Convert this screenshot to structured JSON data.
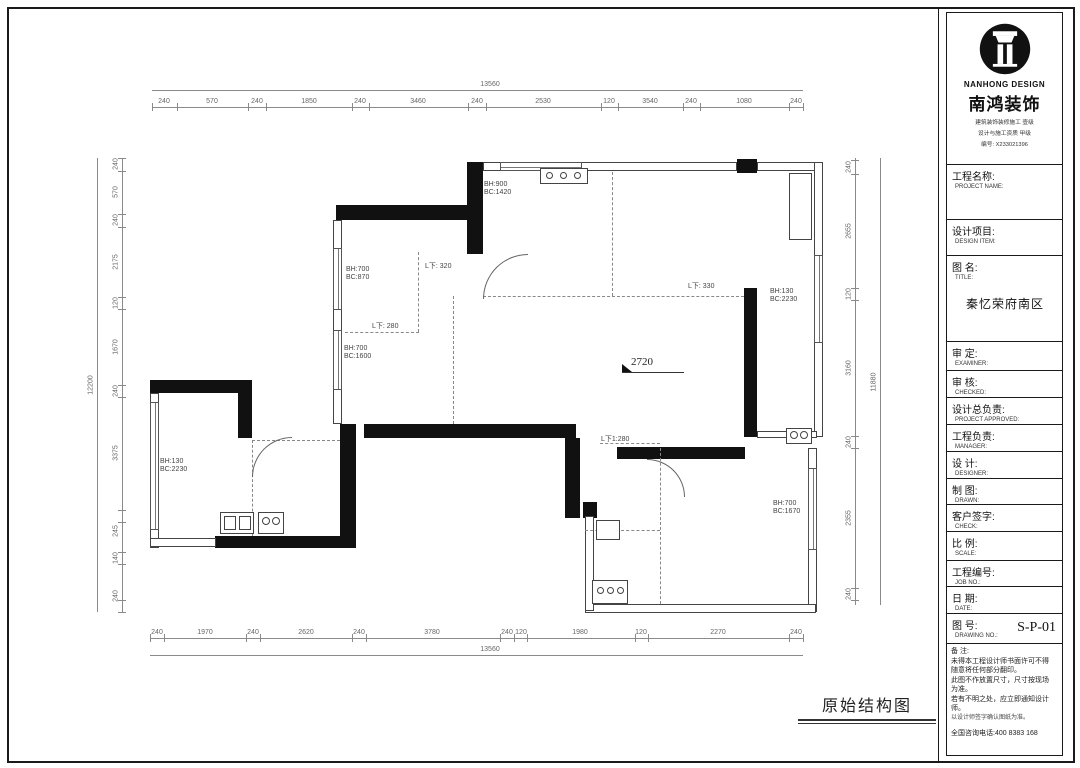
{
  "caption": "原始结构图",
  "titleblock": {
    "brand_en": "NANHONG DESIGN",
    "brand_zh": "南鸿装饰",
    "cert_lines": [
      "建筑装饰装修施工 壹级",
      "设计与施工资质 甲级",
      "编号: X233021396"
    ],
    "rows": [
      {
        "zh": "工程名称:",
        "en": "PROJECT NAME:",
        "h": 55
      },
      {
        "zh": "设计项目:",
        "en": "DESIGN ITEM:",
        "h": 36
      },
      {
        "zh": "图  名:",
        "en": "TITLE:",
        "value": "秦忆荣府南区",
        "h": 86
      },
      {
        "zh": "审  定:",
        "en": "EXAMINER:",
        "h": 29
      },
      {
        "zh": "审  核:",
        "en": "CHECKED:",
        "h": 27
      },
      {
        "zh": "设计总负责:",
        "en": "PROJECT APPROVED:",
        "h": 27
      },
      {
        "zh": "工程负责:",
        "en": "MANAGER:",
        "h": 27
      },
      {
        "zh": "设  计:",
        "en": "DESIGNER:",
        "h": 27
      },
      {
        "zh": "制  图:",
        "en": "DRAWN:",
        "h": 26
      },
      {
        "zh": "客户签字:",
        "en": "CHECK:",
        "h": 27
      },
      {
        "zh": "比  例:",
        "en": "SCALE:",
        "h": 29
      },
      {
        "zh": "工程编号:",
        "en": "JOB NO.:",
        "h": 26
      },
      {
        "zh": "日  期:",
        "en": "DATE:",
        "h": 27
      },
      {
        "zh": "图  号:",
        "en": "DRAWING NO.:",
        "drawing_no": "S-P-01",
        "h": 30
      }
    ],
    "notes": [
      {
        "text": "备  注:",
        "cls": ""
      },
      {
        "text": "未得本工程设计师书面许可不得",
        "cls": ""
      },
      {
        "text": "随意将任何部分翻印。",
        "cls": ""
      },
      {
        "text": "此图不作放置尺寸，尺寸按现场",
        "cls": ""
      },
      {
        "text": "为准。",
        "cls": ""
      },
      {
        "text": "若有不明之处，应立即通知设计",
        "cls": ""
      },
      {
        "text": "师。",
        "cls": ""
      },
      {
        "text": "以设计师签字确认图纸为准。",
        "cls": "small"
      },
      {
        "text": "全国咨询电话:400 8383 168",
        "cls": "phone"
      }
    ]
  },
  "plan": {
    "level_label": "2720",
    "chains": [
      {
        "o": "h",
        "line": 90,
        "a0": 152,
        "a1": 803,
        "labels": [
          {
            "v": "13560",
            "p": 490
          }
        ]
      },
      {
        "o": "h",
        "line": 107,
        "a0": 152,
        "a1": 803,
        "ticks": [
          152,
          177,
          248,
          266,
          352,
          369,
          468,
          486,
          601,
          618,
          683,
          700,
          789,
          803
        ],
        "labels": [
          {
            "v": "240",
            "p": 164
          },
          {
            "v": "570",
            "p": 212
          },
          {
            "v": "240",
            "p": 257
          },
          {
            "v": "1850",
            "p": 309
          },
          {
            "v": "240",
            "p": 360
          },
          {
            "v": "3460",
            "p": 418
          },
          {
            "v": "240",
            "p": 477
          },
          {
            "v": "2530",
            "p": 543
          },
          {
            "v": "120",
            "p": 609
          },
          {
            "v": "3540",
            "p": 650
          },
          {
            "v": "240",
            "p": 691
          },
          {
            "v": "1080",
            "p": 744
          },
          {
            "v": "240",
            "p": 796
          }
        ]
      },
      {
        "o": "h",
        "line": 638,
        "a0": 150,
        "a1": 803,
        "ticks": [
          150,
          164,
          246,
          260,
          352,
          366,
          500,
          514,
          527,
          635,
          648,
          789,
          803
        ],
        "labels": [
          {
            "v": "240",
            "p": 157
          },
          {
            "v": "1970",
            "p": 205
          },
          {
            "v": "240",
            "p": 253
          },
          {
            "v": "2620",
            "p": 306
          },
          {
            "v": "240",
            "p": 359
          },
          {
            "v": "3780",
            "p": 432
          },
          {
            "v": "240",
            "p": 507
          },
          {
            "v": "120",
            "p": 521
          },
          {
            "v": "1980",
            "p": 580
          },
          {
            "v": "120",
            "p": 641
          },
          {
            "v": "2270",
            "p": 718
          },
          {
            "v": "240",
            "p": 796
          }
        ]
      },
      {
        "o": "h",
        "line": 655,
        "a0": 150,
        "a1": 803,
        "labels": [
          {
            "v": "13560",
            "p": 490
          }
        ]
      },
      {
        "o": "v",
        "line": 122,
        "a0": 158,
        "a1": 612,
        "ticks": [
          158,
          171,
          214,
          227,
          297,
          309,
          385,
          397,
          510,
          522,
          552,
          564,
          600,
          612
        ],
        "labels": [
          {
            "v": "240",
            "p": 164
          },
          {
            "v": "570",
            "p": 192
          },
          {
            "v": "240",
            "p": 220
          },
          {
            "v": "2175",
            "p": 262
          },
          {
            "v": "120",
            "p": 303
          },
          {
            "v": "1670",
            "p": 347
          },
          {
            "v": "240",
            "p": 391
          },
          {
            "v": "3375",
            "p": 453
          },
          {
            "v": "245",
            "p": 531
          },
          {
            "v": "140",
            "p": 558
          },
          {
            "v": "240",
            "p": 596
          }
        ]
      },
      {
        "o": "v",
        "line": 97,
        "a0": 158,
        "a1": 612,
        "labels": [
          {
            "v": "12200",
            "p": 385
          }
        ]
      },
      {
        "o": "v",
        "line": 855,
        "a0": 158,
        "a1": 605,
        "ticks": [
          160,
          174,
          288,
          300,
          436,
          448,
          588,
          600
        ],
        "labels": [
          {
            "v": "240",
            "p": 167
          },
          {
            "v": "2655",
            "p": 231
          },
          {
            "v": "120",
            "p": 294
          },
          {
            "v": "3160",
            "p": 368
          },
          {
            "v": "240",
            "p": 442
          },
          {
            "v": "2355",
            "p": 518
          },
          {
            "v": "240",
            "p": 594
          }
        ]
      },
      {
        "o": "v",
        "line": 880,
        "a0": 158,
        "a1": 605,
        "labels": [
          {
            "v": "11880",
            "p": 382
          }
        ]
      }
    ],
    "elements": [
      {
        "t": "black",
        "x": 336,
        "y": 205,
        "w": 147,
        "h": 15
      },
      {
        "t": "black",
        "x": 467,
        "y": 162,
        "w": 16,
        "h": 92
      },
      {
        "t": "black",
        "x": 737,
        "y": 159,
        "w": 20,
        "h": 14
      },
      {
        "t": "black",
        "x": 744,
        "y": 288,
        "w": 13,
        "h": 149
      },
      {
        "t": "black",
        "x": 364,
        "y": 424,
        "w": 212,
        "h": 14
      },
      {
        "t": "black",
        "x": 340,
        "y": 424,
        "w": 16,
        "h": 124
      },
      {
        "t": "black",
        "x": 215,
        "y": 536,
        "w": 141,
        "h": 12
      },
      {
        "t": "black",
        "x": 565,
        "y": 438,
        "w": 15,
        "h": 80
      },
      {
        "t": "black",
        "x": 583,
        "y": 502,
        "w": 14,
        "h": 16
      },
      {
        "t": "black",
        "x": 617,
        "y": 447,
        "w": 128,
        "h": 12
      },
      {
        "t": "black",
        "x": 150,
        "y": 380,
        "w": 100,
        "h": 13
      },
      {
        "t": "black",
        "x": 238,
        "y": 380,
        "w": 14,
        "h": 58
      },
      {
        "t": "thin",
        "x": 483,
        "y": 162,
        "w": 254,
        "h": 9
      },
      {
        "t": "thin",
        "x": 757,
        "y": 162,
        "w": 65,
        "h": 9
      },
      {
        "t": "thin",
        "x": 814,
        "y": 162,
        "w": 9,
        "h": 275
      },
      {
        "t": "thin",
        "x": 757,
        "y": 431,
        "w": 60,
        "h": 7
      },
      {
        "t": "thin",
        "x": 808,
        "y": 448,
        "w": 9,
        "h": 164
      },
      {
        "t": "thin",
        "x": 585,
        "y": 604,
        "w": 231,
        "h": 9
      },
      {
        "t": "thin",
        "x": 333,
        "y": 220,
        "w": 9,
        "h": 204
      },
      {
        "t": "thin",
        "x": 150,
        "y": 393,
        "w": 9,
        "h": 155
      },
      {
        "t": "thin",
        "x": 150,
        "y": 538,
        "w": 66,
        "h": 9
      },
      {
        "t": "thin",
        "x": 585,
        "y": 516,
        "w": 9,
        "h": 95
      },
      {
        "t": "ro",
        "x": 789,
        "y": 173,
        "w": 23,
        "h": 67
      },
      {
        "t": "win",
        "x": 333,
        "y": 248,
        "w": 9,
        "h": 62
      },
      {
        "t": "win",
        "x": 333,
        "y": 330,
        "w": 9,
        "h": 60
      },
      {
        "t": "win",
        "x": 150,
        "y": 402,
        "w": 9,
        "h": 128
      },
      {
        "t": "win",
        "x": 814,
        "y": 255,
        "w": 9,
        "h": 88
      },
      {
        "t": "win",
        "x": 808,
        "y": 468,
        "w": 9,
        "h": 82
      },
      {
        "t": "win",
        "x": 500,
        "y": 162,
        "w": 82,
        "h": 9
      },
      {
        "t": "dv",
        "x": 418,
        "y": 252,
        "l": 80
      },
      {
        "t": "dh",
        "x": 345,
        "y": 332,
        "l": 74
      },
      {
        "t": "dv",
        "x": 453,
        "y": 296,
        "l": 128
      },
      {
        "t": "dh",
        "x": 483,
        "y": 296,
        "l": 261
      },
      {
        "t": "dv",
        "x": 612,
        "y": 172,
        "l": 124
      },
      {
        "t": "dv",
        "x": 660,
        "y": 448,
        "l": 156
      },
      {
        "t": "dh",
        "x": 600,
        "y": 443,
        "l": 60
      },
      {
        "t": "dh",
        "x": 585,
        "y": 530,
        "l": 75
      },
      {
        "t": "dh",
        "x": 252,
        "y": 440,
        "l": 88
      },
      {
        "t": "dv",
        "x": 252,
        "y": 440,
        "l": 96
      },
      {
        "t": "ro",
        "x": 540,
        "y": 168,
        "w": 48,
        "h": 16
      },
      {
        "t": "circ",
        "x": 546,
        "y": 172,
        "d": 7
      },
      {
        "t": "circ",
        "x": 560,
        "y": 172,
        "d": 7
      },
      {
        "t": "circ",
        "x": 574,
        "y": 172,
        "d": 7
      },
      {
        "t": "ro",
        "x": 220,
        "y": 512,
        "w": 34,
        "h": 22
      },
      {
        "t": "ro",
        "x": 224,
        "y": 516,
        "w": 12,
        "h": 14
      },
      {
        "t": "ro",
        "x": 239,
        "y": 516,
        "w": 12,
        "h": 14
      },
      {
        "t": "ro",
        "x": 258,
        "y": 512,
        "w": 26,
        "h": 22
      },
      {
        "t": "circ",
        "x": 262,
        "y": 517,
        "d": 8
      },
      {
        "t": "circ",
        "x": 272,
        "y": 517,
        "d": 8
      },
      {
        "t": "ro",
        "x": 592,
        "y": 580,
        "w": 36,
        "h": 24
      },
      {
        "t": "circ",
        "x": 597,
        "y": 587,
        "d": 7
      },
      {
        "t": "circ",
        "x": 607,
        "y": 587,
        "d": 7
      },
      {
        "t": "circ",
        "x": 617,
        "y": 587,
        "d": 7
      },
      {
        "t": "ro",
        "x": 596,
        "y": 520,
        "w": 24,
        "h": 20
      },
      {
        "t": "ro",
        "x": 786,
        "y": 428,
        "w": 26,
        "h": 16
      },
      {
        "t": "circ",
        "x": 790,
        "y": 431,
        "d": 8
      },
      {
        "t": "circ",
        "x": 800,
        "y": 431,
        "d": 8
      },
      {
        "t": "arc",
        "x": 483,
        "y": 254,
        "w": 45,
        "h": 45,
        "c": "tl"
      },
      {
        "t": "arc",
        "x": 252,
        "y": 437,
        "w": 40,
        "h": 40,
        "c": "tl"
      },
      {
        "t": "arc",
        "x": 647,
        "y": 459,
        "w": 38,
        "h": 38,
        "c": "tr"
      },
      {
        "t": "lab",
        "text": "BH:900\nBC:1420",
        "x": 484,
        "y": 181
      },
      {
        "t": "lab",
        "text": "BH:700\nBC:870",
        "x": 346,
        "y": 266
      },
      {
        "t": "lab",
        "text": "BH:700\nBC:1600",
        "x": 344,
        "y": 345
      },
      {
        "t": "lab",
        "text": "BH:130\nBC:2230",
        "x": 160,
        "y": 458
      },
      {
        "t": "lab",
        "text": "BH:130\nBC:2230",
        "x": 770,
        "y": 288
      },
      {
        "t": "lab",
        "text": "BH:700\nBC:1670",
        "x": 773,
        "y": 500
      },
      {
        "t": "lab",
        "text": "L下: 320",
        "x": 425,
        "y": 263
      },
      {
        "t": "lab",
        "text": "L下: 280",
        "x": 372,
        "y": 323
      },
      {
        "t": "lab",
        "text": "L下: 330",
        "x": 688,
        "y": 283
      },
      {
        "t": "lab",
        "text": "L下1:280",
        "x": 601,
        "y": 436
      },
      {
        "t": "lvl",
        "text": "2720",
        "x": 631,
        "y": 356
      },
      {
        "t": "hl",
        "x": 622,
        "y": 372,
        "l": 62,
        "dk": true
      },
      {
        "t": "tri",
        "x": 622,
        "y": 364
      }
    ]
  }
}
